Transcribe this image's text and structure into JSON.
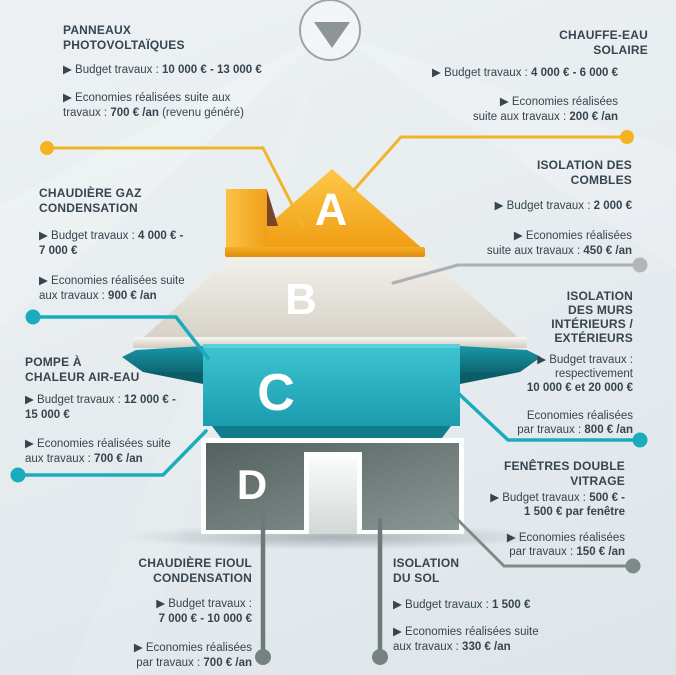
{
  "palette": {
    "yellow": "#F2B427",
    "teal": "#1BACBC",
    "gray_light": "#ACB0B5",
    "gray_dark": "#75817E",
    "text": "#36454F",
    "roof_a": "#F5A81F",
    "roof_b": "#DEDACF",
    "wall_c": "#28B6C6",
    "wall_d": "#6C7977"
  },
  "top_icon": {
    "name": "down-arrow"
  },
  "house": {
    "levels": [
      {
        "letter": "A",
        "color": "#F5A81F"
      },
      {
        "letter": "B",
        "color": "#DEDACF"
      },
      {
        "letter": "C",
        "color": "#28B6C6"
      },
      {
        "letter": "D",
        "color": "#6C7977"
      }
    ]
  },
  "labels": {
    "panneaux": {
      "heading": "PANNEAUX\nPHOTOVOLTAÏQUES",
      "lines": [
        {
          "pre": "▶ Budget travaux : ",
          "bold": "10 000 € - 13 000 €",
          "post": ""
        },
        {
          "pre": "▶ Economies réalisées suite aux",
          "bold": "",
          "post": ""
        },
        {
          "pre": "travaux : ",
          "bold": "700 € /an",
          "post": " (revenu généré)"
        }
      ]
    },
    "chauffe_eau": {
      "heading": "CHAUFFE-EAU\nSOLAIRE",
      "lines": [
        {
          "pre": "▶ Budget travaux : ",
          "bold": "4 000 € - 6 000 €",
          "post": ""
        },
        {
          "pre": "▶ Economies réalisées",
          "bold": "",
          "post": ""
        },
        {
          "pre": "suite aux travaux : ",
          "bold": "200 € /an",
          "post": ""
        }
      ]
    },
    "combles": {
      "heading": "ISOLATION DES\nCOMBLES",
      "lines": [
        {
          "pre": "▶ Budget travaux : ",
          "bold": "2 000 €",
          "post": ""
        },
        {
          "pre": "▶ Economies réalisées",
          "bold": "",
          "post": ""
        },
        {
          "pre": "suite aux travaux : ",
          "bold": "450 € /an",
          "post": ""
        }
      ]
    },
    "murs": {
      "heading": "ISOLATION\nDES MURS\nINTÉRIEURS /\nEXTÉRIEURS",
      "lines": [
        {
          "pre": "▶ Budget travaux :",
          "bold": "",
          "post": ""
        },
        {
          "pre": "respectivement",
          "bold": "",
          "post": ""
        },
        {
          "pre": "",
          "bold": "10 000 € et  20 000 €",
          "post": ""
        },
        {
          "pre": "Economies réalisées",
          "bold": "",
          "post": ""
        },
        {
          "pre": "par travaux : ",
          "bold": "800 € /an",
          "post": ""
        }
      ]
    },
    "fenetres": {
      "heading": "FENÊTRES DOUBLE\nVITRAGE",
      "lines": [
        {
          "pre": "▶ Budget travaux : ",
          "bold": "500 € -",
          "post": ""
        },
        {
          "pre": "",
          "bold": "1 500 € par fenêtre",
          "post": ""
        },
        {
          "pre": "▶ Economies réalisées",
          "bold": "",
          "post": ""
        },
        {
          "pre": "par travaux : ",
          "bold": "150 € /an",
          "post": ""
        }
      ]
    },
    "gaz": {
      "heading": "CHAUDIÈRE GAZ\nCONDENSATION",
      "lines": [
        {
          "pre": "▶ Budget travaux : ",
          "bold": "4 000 € -",
          "post": ""
        },
        {
          "pre": "",
          "bold": "7 000 €",
          "post": ""
        },
        {
          "pre": "▶ Economies réalisées suite",
          "bold": "",
          "post": ""
        },
        {
          "pre": "aux travaux : ",
          "bold": "900 € /an",
          "post": ""
        }
      ]
    },
    "pompe": {
      "heading": "POMPE À\nCHALEUR AIR-EAU",
      "lines": [
        {
          "pre": "▶ Budget travaux : ",
          "bold": "12 000 € -",
          "post": ""
        },
        {
          "pre": "",
          "bold": "15 000 €",
          "post": ""
        },
        {
          "pre": "▶ Economies réalisées suite",
          "bold": "",
          "post": ""
        },
        {
          "pre": "aux travaux : ",
          "bold": "700 € /an",
          "post": ""
        }
      ]
    },
    "fioul": {
      "heading": "CHAUDIÈRE FIOUL\nCONDENSATION",
      "lines": [
        {
          "pre": "▶ Budget travaux :",
          "bold": "",
          "post": ""
        },
        {
          "pre": "",
          "bold": "7 000 € - 10 000 €",
          "post": ""
        },
        {
          "pre": "▶ Economies réalisées",
          "bold": "",
          "post": ""
        },
        {
          "pre": "par travaux : ",
          "bold": "700 € /an",
          "post": ""
        }
      ]
    },
    "sol": {
      "heading": "ISOLATION\nDU SOL",
      "lines": [
        {
          "pre": "▶ Budget travaux : ",
          "bold": "1 500 €",
          "post": ""
        },
        {
          "pre": "▶ Economies réalisées suite",
          "bold": "",
          "post": ""
        },
        {
          "pre": "aux travaux : ",
          "bold": "330 € /an",
          "post": ""
        }
      ]
    }
  }
}
